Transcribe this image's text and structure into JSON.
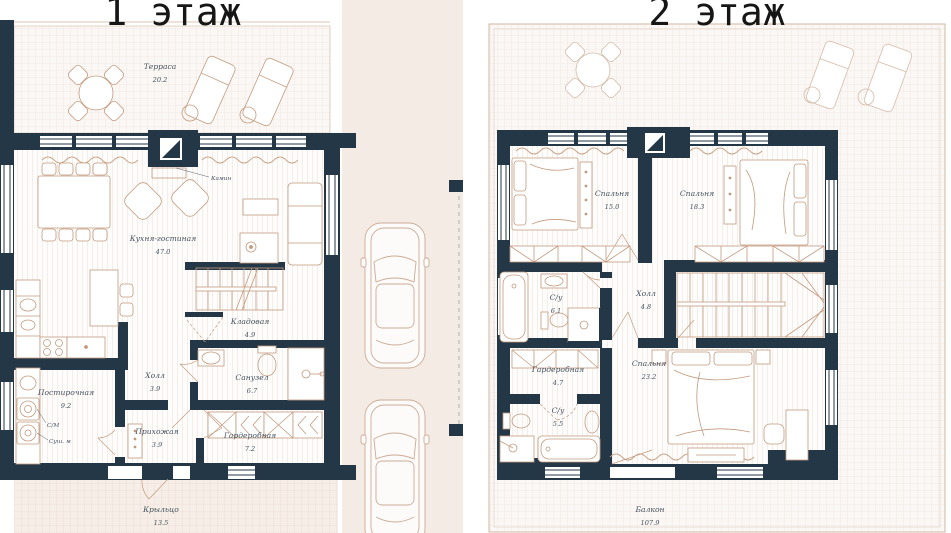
{
  "titles": {
    "floor1": "1 этаж",
    "floor2": "2 этаж"
  },
  "floor1": {
    "rooms": {
      "terrace": {
        "name": "Терраса",
        "area": "20.2"
      },
      "kitchen_living": {
        "name": "Кухня-гостиная",
        "area": "47.0"
      },
      "storage": {
        "name": "Кладовая",
        "area": "4.9"
      },
      "bathroom": {
        "name": "Санузел",
        "area": "6.7"
      },
      "hall": {
        "name": "Холл",
        "area": "3.9"
      },
      "laundry": {
        "name": "Постирочная",
        "area": "9.2"
      },
      "entry": {
        "name": "Прихожая",
        "area": "3.9"
      },
      "wardrobe": {
        "name": "Гардеробная",
        "area": "7.2"
      },
      "porch": {
        "name": "Крыльцо",
        "area": "13.5"
      }
    },
    "annotations": {
      "fireplace": "Камин",
      "washer": "С/М",
      "dryer": "Суш. м"
    }
  },
  "floor2": {
    "rooms": {
      "bedroom1": {
        "name": "Спальня",
        "area": "15.0"
      },
      "bedroom2": {
        "name": "Спальня",
        "area": "18.3"
      },
      "bathroom1": {
        "name": "С/у",
        "area": "6.1"
      },
      "hall": {
        "name": "Холл",
        "area": "4.8"
      },
      "wardrobe": {
        "name": "Гардеробная",
        "area": "4.7"
      },
      "bedroom3": {
        "name": "Спальня",
        "area": "23.2"
      },
      "bathroom2": {
        "name": "С/у",
        "area": "5.5"
      },
      "balcony": {
        "name": "Балкон",
        "area": "107.9"
      }
    }
  },
  "colors": {
    "wall": "#243747",
    "furniture_line": "#c39a7e",
    "outdoor_fill": "#f5ebe5",
    "label_text": "#44525e"
  }
}
